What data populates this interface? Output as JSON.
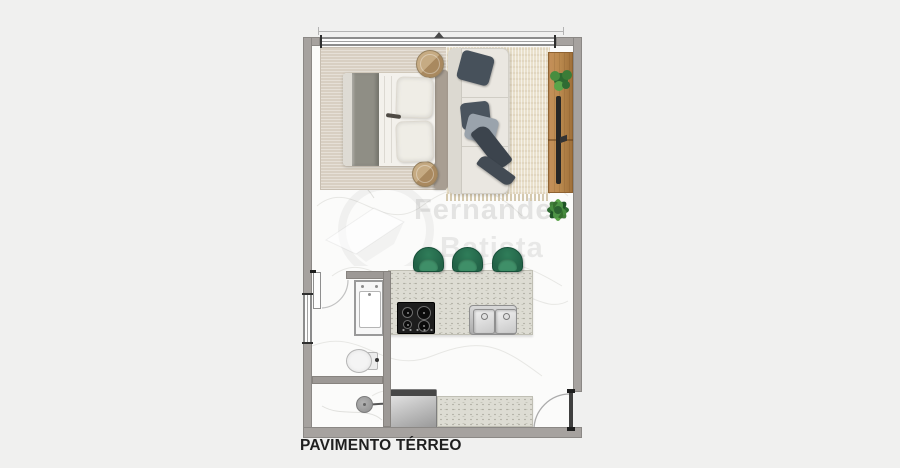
{
  "title": {
    "label": "PAVIMENTO TÉRREO"
  },
  "watermark": {
    "line1": "Fernandez",
    "line2": "Batista"
  },
  "colors": {
    "bg": "#f0f0ef",
    "floor": "#fbfbfa",
    "wall": "#a6a29f",
    "wallDark": "#8b8885",
    "wood": "#bb8a4f",
    "woodDark": "#8e6231",
    "plantDark": "#2d6a31",
    "plant": "#478d3f",
    "plantLight": "#5aa449",
    "stool": "#236348",
    "stoolLight": "#3f8f68",
    "counter": "#dddcd3",
    "rugBedroom": "#d8cfc2",
    "rugLiving": "#e9e0cb",
    "sofa": "#eae7e1",
    "bedding": "#f3f1ec",
    "blanketGray": "#8f8e85",
    "pillowDark": "#47515b",
    "throwGray": "#9aa3ac",
    "titleText": "#1f1f1f"
  },
  "fixtures": {
    "list": [
      "double-bed",
      "nightstand-left",
      "nightstand-right",
      "sofa",
      "throw-pillows",
      "living-rug",
      "bedroom-rug",
      "tv-wood-panel",
      "panel-plant",
      "floor-plant",
      "bar-stools-x3",
      "kitchen-island",
      "gas-cooktop",
      "double-sink",
      "bathroom-vanity",
      "toilet",
      "shower",
      "washing-machine",
      "service-counter",
      "entry-door",
      "bathroom-door",
      "top-window",
      "bathroom-window"
    ]
  }
}
